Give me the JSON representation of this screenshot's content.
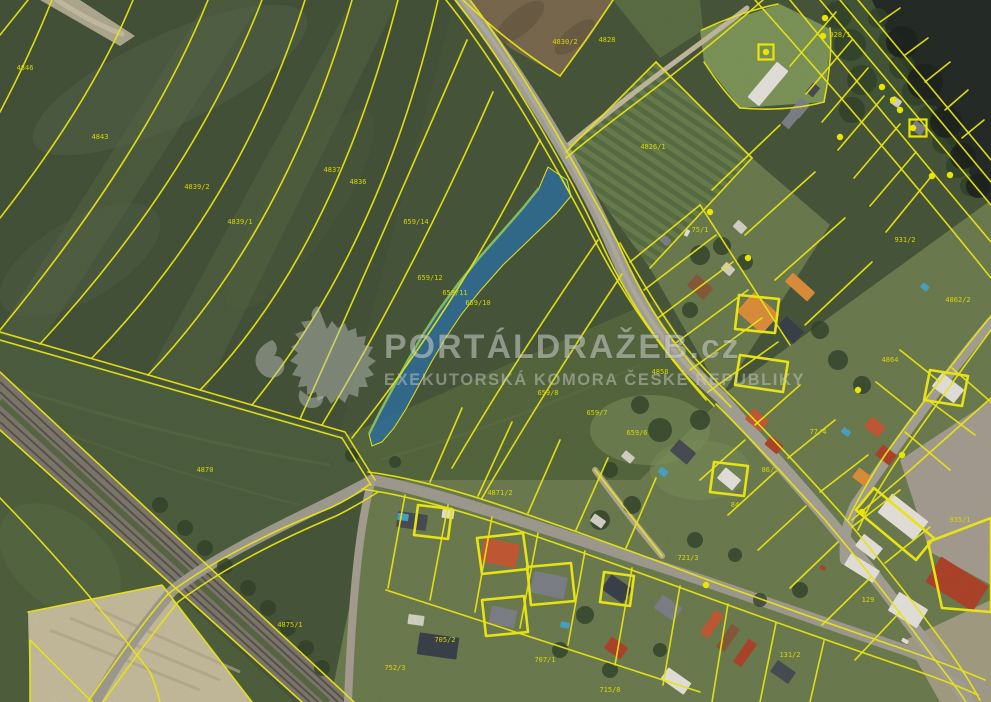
{
  "app": {
    "type": "cadastral-aerial-map-view"
  },
  "watermark": {
    "logo": "heraldic-lion",
    "title": "PORTÁLDRAŽEB.cz",
    "subtitle": "EXEKUTORSKÁ KOMORA ČESKÉ REPUBLIKY"
  },
  "colors": {
    "parcel_line": "#f3ef15",
    "parcel_label": "#e8e400",
    "marker": "#f6f200",
    "highlight_fill": "#2f73a3",
    "highlight_edge": "#8cc468",
    "water": "#262c28",
    "road_asphalt": "#a8a499",
    "road_dirt": "#c6bca2",
    "railway": "#807b6e",
    "tree": "#33452c",
    "roof_red": "#b2452c",
    "roof_red2": "#c75b36",
    "roof_orange": "#e0923c",
    "roof_brown": "#8a5c3c",
    "roof_gray": "#80838a",
    "roof_dkgray": "#4a4f55",
    "roof_navy": "#3c434b",
    "bldg_white": "#e9e7df",
    "bldg_lt": "#d8d5c9",
    "pool": "#4aa7c8"
  },
  "highlight_parcel": {
    "label": "659/11",
    "fill_opacity": 0.82
  },
  "parcel_labels": [
    {
      "t": "4846",
      "x": 25,
      "y": 70
    },
    {
      "t": "4843",
      "x": 100,
      "y": 139
    },
    {
      "t": "4839/2",
      "x": 197,
      "y": 189
    },
    {
      "t": "4839/1",
      "x": 240,
      "y": 224
    },
    {
      "t": "4837",
      "x": 332,
      "y": 172
    },
    {
      "t": "4836",
      "x": 358,
      "y": 184
    },
    {
      "t": "659/14",
      "x": 416,
      "y": 224
    },
    {
      "t": "659/12",
      "x": 430,
      "y": 280
    },
    {
      "t": "659/11",
      "x": 455,
      "y": 295
    },
    {
      "t": "659/10",
      "x": 478,
      "y": 305
    },
    {
      "t": "659/8",
      "x": 548,
      "y": 395
    },
    {
      "t": "659/7",
      "x": 597,
      "y": 415
    },
    {
      "t": "659/6",
      "x": 637,
      "y": 435
    },
    {
      "t": "4828",
      "x": 607,
      "y": 42
    },
    {
      "t": "4826/1",
      "x": 653,
      "y": 149
    },
    {
      "t": "4870",
      "x": 205,
      "y": 472
    },
    {
      "t": "4871/2",
      "x": 500,
      "y": 495
    },
    {
      "t": "4875/1",
      "x": 290,
      "y": 627
    },
    {
      "t": "752/3",
      "x": 395,
      "y": 670
    },
    {
      "t": "75/1",
      "x": 700,
      "y": 232
    },
    {
      "t": "84",
      "x": 735,
      "y": 507
    },
    {
      "t": "86/2",
      "x": 770,
      "y": 472
    },
    {
      "t": "721/3",
      "x": 688,
      "y": 560
    },
    {
      "t": "705/2",
      "x": 445,
      "y": 642
    },
    {
      "t": "707/1",
      "x": 545,
      "y": 662
    },
    {
      "t": "715/8",
      "x": 610,
      "y": 692
    },
    {
      "t": "131/2",
      "x": 790,
      "y": 657
    },
    {
      "t": "129",
      "x": 868,
      "y": 602
    },
    {
      "t": "935/1",
      "x": 960,
      "y": 522
    },
    {
      "t": "931/2",
      "x": 905,
      "y": 242
    },
    {
      "t": "928/1",
      "x": 840,
      "y": 37
    },
    {
      "t": "4864",
      "x": 890,
      "y": 362
    },
    {
      "t": "4862/2",
      "x": 958,
      "y": 302
    },
    {
      "t": "77/4",
      "x": 818,
      "y": 434
    },
    {
      "t": "4858",
      "x": 660,
      "y": 374
    },
    {
      "t": "4830/2",
      "x": 565,
      "y": 44
    }
  ],
  "point_markers": {
    "dots": [
      [
        825,
        18
      ],
      [
        823,
        36
      ],
      [
        882,
        87
      ],
      [
        893,
        100
      ],
      [
        900,
        110
      ],
      [
        913,
        128
      ],
      [
        840,
        137
      ],
      [
        950,
        175
      ],
      [
        766,
        52
      ],
      [
        710,
        212
      ],
      [
        748,
        258
      ],
      [
        858,
        390
      ],
      [
        932,
        176
      ],
      [
        902,
        455
      ],
      [
        862,
        512
      ],
      [
        706,
        585
      ]
    ],
    "squares": [
      [
        766,
        52,
        15
      ],
      [
        918,
        128,
        17
      ]
    ]
  },
  "houses": [
    [
      412,
      521,
      30,
      16,
      8,
      "roof_dkgray"
    ],
    [
      448,
      514,
      12,
      9,
      8,
      "bldg_white"
    ],
    [
      500,
      553,
      36,
      24,
      12,
      "roof_red2"
    ],
    [
      549,
      585,
      34,
      22,
      12,
      "roof_gray"
    ],
    [
      503,
      617,
      26,
      18,
      12,
      "roof_gray"
    ],
    [
      438,
      646,
      40,
      22,
      8,
      "roof_navy"
    ],
    [
      416,
      620,
      16,
      10,
      8,
      "bldg_lt"
    ],
    [
      617,
      589,
      26,
      18,
      35,
      "roof_navy"
    ],
    [
      668,
      608,
      24,
      16,
      35,
      "roof_gray"
    ],
    [
      616,
      648,
      20,
      14,
      35,
      "roof_red"
    ],
    [
      676,
      681,
      28,
      14,
      35,
      "bldg_white"
    ],
    [
      712,
      624,
      28,
      10,
      -55,
      "roof_red2"
    ],
    [
      728,
      638,
      28,
      10,
      -55,
      "roof_brown"
    ],
    [
      745,
      653,
      28,
      10,
      -55,
      "roof_red"
    ],
    [
      783,
      672,
      22,
      14,
      35,
      "roof_dkgray"
    ],
    [
      862,
      568,
      34,
      14,
      32,
      "bldg_white"
    ],
    [
      908,
      610,
      34,
      22,
      32,
      "bldg_white"
    ],
    [
      957,
      584,
      56,
      30,
      32,
      "roof_red"
    ],
    [
      903,
      517,
      46,
      24,
      38,
      "bldg_white"
    ],
    [
      869,
      547,
      24,
      15,
      38,
      "bldg_white"
    ],
    [
      948,
      388,
      28,
      17,
      38,
      "bldg_white"
    ],
    [
      875,
      427,
      18,
      13,
      38,
      "roof_red2"
    ],
    [
      886,
      455,
      18,
      13,
      38,
      "roof_red"
    ],
    [
      862,
      477,
      16,
      12,
      38,
      "roof_orange"
    ],
    [
      758,
      313,
      34,
      26,
      42,
      "roof_orange"
    ],
    [
      800,
      287,
      30,
      12,
      42,
      "roof_orange"
    ],
    [
      790,
      330,
      24,
      16,
      42,
      "roof_navy"
    ],
    [
      700,
      287,
      22,
      15,
      42,
      "roof_brown"
    ],
    [
      728,
      269,
      12,
      9,
      42,
      "bldg_lt"
    ],
    [
      683,
      452,
      22,
      15,
      40,
      "roof_dkgray"
    ],
    [
      729,
      479,
      20,
      14,
      40,
      "bldg_white"
    ],
    [
      757,
      420,
      20,
      14,
      40,
      "roof_red2"
    ],
    [
      774,
      445,
      16,
      11,
      40,
      "roof_red"
    ],
    [
      768,
      84,
      46,
      15,
      -50,
      "bldg_white"
    ],
    [
      800,
      108,
      18,
      12,
      -50,
      "roof_gray"
    ],
    [
      813,
      90,
      12,
      9,
      -50,
      "roof_dkgray"
    ],
    [
      918,
      128,
      13,
      10,
      35,
      "roof_gray"
    ],
    [
      896,
      102,
      10,
      8,
      35,
      "bldg_lt"
    ],
    [
      740,
      227,
      12,
      9,
      42,
      "bldg_lt"
    ],
    [
      665,
      240,
      10,
      8,
      42,
      "roof_gray"
    ],
    [
      790,
      120,
      16,
      10,
      -50,
      "roof_gray"
    ],
    [
      628,
      457,
      12,
      8,
      40,
      "bldg_lt"
    ],
    [
      598,
      521,
      14,
      9,
      35,
      "bldg_lt"
    ],
    [
      403,
      517,
      11,
      7,
      8,
      "pool"
    ],
    [
      663,
      472,
      9,
      7,
      40,
      "pool"
    ],
    [
      846,
      432,
      9,
      6,
      38,
      "pool"
    ],
    [
      925,
      287,
      8,
      6,
      38,
      "pool"
    ],
    [
      565,
      625,
      9,
      6,
      12,
      "pool"
    ],
    [
      687,
      233,
      7,
      4,
      -62,
      "bldg_white"
    ],
    [
      823,
      568,
      6,
      4,
      30,
      "roof_red"
    ],
    [
      905,
      641,
      7,
      4,
      30,
      "bldg_white"
    ]
  ],
  "trees": [
    [
      878,
      18,
      10
    ],
    [
      890,
      42,
      12
    ],
    [
      902,
      66,
      13
    ],
    [
      916,
      92,
      14
    ],
    [
      930,
      118,
      13
    ],
    [
      944,
      142,
      12
    ],
    [
      958,
      166,
      12
    ],
    [
      970,
      186,
      10
    ],
    [
      838,
      15,
      14
    ],
    [
      850,
      45,
      16
    ],
    [
      862,
      80,
      15
    ],
    [
      852,
      110,
      13
    ],
    [
      700,
      255,
      10
    ],
    [
      722,
      246,
      9
    ],
    [
      745,
      262,
      8
    ],
    [
      690,
      310,
      8
    ],
    [
      820,
      330,
      9
    ],
    [
      838,
      360,
      10
    ],
    [
      862,
      385,
      9
    ],
    [
      700,
      420,
      10
    ],
    [
      660,
      430,
      12
    ],
    [
      640,
      405,
      9
    ],
    [
      610,
      470,
      8
    ],
    [
      632,
      505,
      9
    ],
    [
      600,
      520,
      10
    ],
    [
      585,
      615,
      9
    ],
    [
      560,
      650,
      8
    ],
    [
      610,
      670,
      8
    ],
    [
      660,
      650,
      7
    ],
    [
      760,
      600,
      7
    ],
    [
      800,
      590,
      8
    ],
    [
      735,
      555,
      7
    ],
    [
      695,
      540,
      8
    ],
    [
      352,
      455,
      7
    ],
    [
      395,
      462,
      6
    ],
    [
      160,
      505,
      8
    ],
    [
      185,
      528,
      8
    ],
    [
      205,
      548,
      8
    ],
    [
      225,
      566,
      8
    ],
    [
      248,
      588,
      8
    ],
    [
      268,
      608,
      8
    ],
    [
      288,
      628,
      8
    ],
    [
      306,
      648,
      8
    ],
    [
      322,
      668,
      8
    ]
  ],
  "water_shadows": [
    [
      902,
      42,
      16
    ],
    [
      925,
      82,
      18
    ],
    [
      946,
      122,
      16
    ],
    [
      963,
      156,
      13
    ],
    [
      978,
      186,
      12
    ]
  ],
  "cadastral_lines": [
    "M52,0 Q30,55 0,112",
    "M133,0 Q92,100 0,218",
    "M208,0 Q148,150 0,330",
    "M262,0 Q192,180 40,344",
    "M305,0 Q240,205 92,358",
    "M352,0 Q286,230 148,375",
    "M398,0 Q332,255 200,390",
    "M438,0 Q382,245 252,405",
    "M467,40 Q385,230 300,419",
    "M493,92 Q415,270 322,425",
    "M540,140 Q462,300 352,438",
    "M598,240 Q515,360 452,468",
    "M622,274 Q545,390 482,498",
    "M455,0 C503,60 560,155 600,240 C625,295 658,348 714,406",
    "M470,0 C517,62 572,158 618,243 C643,300 673,350 731,407",
    "M446,0 C494,60 548,150 592,235 C616,282 648,334 706,400",
    "M0,332 L345,432 L375,480",
    "M0,340 L342,438 L371,485",
    "M0,372 L354,702",
    "M0,430 L302,702",
    "M88,702 Q140,625 168,594 Q230,548 330,508 Q352,498 370,484",
    "M103,702 Q152,634 178,602 Q240,556 336,516 Q358,505 378,492",
    "M28,612 L162,585 L252,702",
    "M30,702 L30,640 L92,702",
    "M0,498 Q80,580 150,672 Q156,686 160,702",
    "M463,0 Q510,45 560,76",
    "M560,76 Q590,35 613,0",
    "M763,0 Q700,55 620,115 Q585,142 566,158",
    "M702,30 Q740,12 778,4",
    "M704,62 Q722,90 740,108",
    "M740,108 Q786,112 824,102",
    "M824,102 Q833,55 830,28",
    "M656,62 L752,158",
    "M752,158 L650,268",
    "M566,152 L656,62",
    "M858,0 L991,160",
    "M840,0 L991,182",
    "M820,0 L991,205",
    "M790,0 Q880,110 991,242",
    "M755,0 Q880,140 991,278",
    "M880,22 L900,8",
    "M905,55 L928,38",
    "M925,82 L950,62",
    "M945,110 L968,90",
    "M962,138 L984,120",
    "M836,12 L790,66",
    "M852,40 L806,94",
    "M868,68 L822,122",
    "M884,96 L838,150",
    "M900,124 L854,178",
    "M916,152 L870,206",
    "M930,178 L886,232",
    "M620,243 Q652,300 680,340 Q702,368 735,400",
    "M630,262 L700,205",
    "M644,290 L716,235",
    "M658,318 L733,262",
    "M673,345 L748,290",
    "M690,370 L762,318",
    "M708,392 L778,342",
    "M700,205 Q745,275 790,345",
    "M712,190 L780,125",
    "M745,235 L815,172",
    "M775,280 L845,218",
    "M805,325 L872,262",
    "M716,404 Q760,448 825,520 Q880,585 935,660 Q955,685 966,702",
    "M733,398 Q775,440 840,512 Q895,577 950,652 Q968,678 980,700",
    "M745,440 L700,480",
    "M775,472 L728,515",
    "M806,506 L758,550",
    "M838,542 L790,588",
    "M870,578 L822,625",
    "M900,612 L855,660",
    "M755,425 L800,385",
    "M788,458 L835,420",
    "M820,492 L868,455",
    "M852,527 L900,490",
    "M885,563 L930,527",
    "M368,472 Q430,480 520,512 Q610,543 700,577 Q790,610 900,648 Q950,665 985,680",
    "M362,489 Q420,497 512,528 Q605,560 695,593 Q788,627 896,664 Q945,680 978,695",
    "M430,482 L462,408",
    "M478,496 L512,422",
    "M528,513 L560,440",
    "M576,530 L608,458",
    "M626,548 L656,478",
    "M405,495 L388,588",
    "M448,505 L430,600",
    "M492,517 L475,612",
    "M538,533 L520,628",
    "M585,551 L568,645",
    "M632,568 L615,665",
    "M680,586 L663,685",
    "M728,604 L712,702",
    "M776,623 L760,702",
    "M824,641 L810,702",
    "M386,590 Q540,640 700,692",
    "M991,316 Q940,378 885,455 Q862,490 848,520",
    "M991,330 Q948,388 896,462 Q872,498 858,530",
    "M952,368 L991,402",
    "M928,400 L975,435",
    "M905,432 L950,470",
    "M940,382 L900,350",
    "M916,414 L876,382",
    "M908,472 L991,398",
    "M852,520 L908,472",
    "M28,0 L0,35",
    "M595,470 Q625,508 662,556"
  ],
  "parcel_outlines": [
    "M477,538 L523,533 L528,569 L482,574 Z",
    "M527,567 L571,563 L575,601 L531,605 Z",
    "M482,600 L524,596 L528,632 L486,636 Z",
    "M739,295 L779,299 L775,333 L735,329 Z",
    "M714,462 L748,466 L744,496 L710,492 Z",
    "M930,370 L968,376 L962,406 L924,400 Z",
    "M740,355 L788,362 L783,392 L735,385 Z",
    "M874,488 L934,538 L916,560 L856,510 Z",
    "M928,542 L991,518 L991,612 L942,608 Z",
    "M418,505 L452,509 L448,539 L414,535 Z",
    "M604,572 L634,576 L630,606 L600,602 Z"
  ]
}
